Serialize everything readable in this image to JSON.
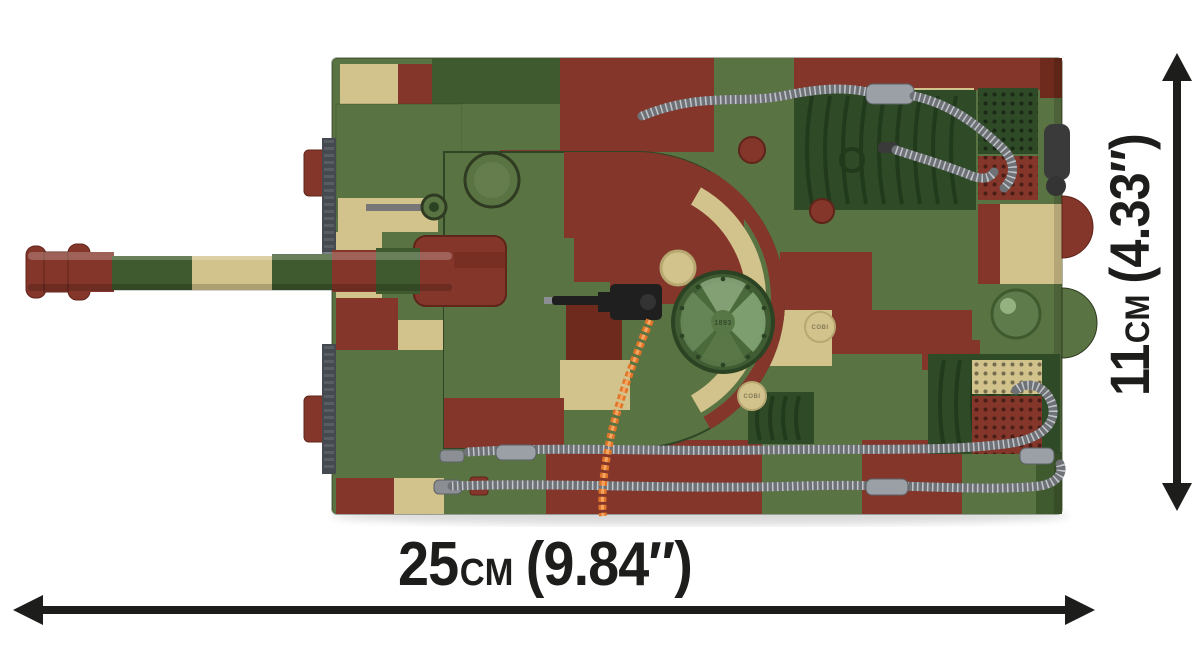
{
  "label_width": {
    "value": "25",
    "unit": "cm",
    "imperial": "(9.84″)"
  },
  "label_height": {
    "value": "11",
    "unit": "cm",
    "imperial": "(4.33″)"
  },
  "embossed": {
    "hatch_text": "1893",
    "stud_text": "COBI"
  },
  "colors": {
    "background": "#ffffff",
    "ink": "#1d1d1b",
    "camo_green": "#5a7342",
    "camo_green_dark": "#3f5a2e",
    "camo_tan": "#d2c28b",
    "camo_maroon": "#84362a",
    "camo_maroon_dark": "#6d2a1d",
    "deck_green": "#2f4a26",
    "deck_rib": "#1f3519",
    "hose_gray": "#6e7277",
    "hose_light": "#c2c6cb",
    "rope_orange": "#e0752a",
    "metal_black": "#1f1f1f"
  }
}
